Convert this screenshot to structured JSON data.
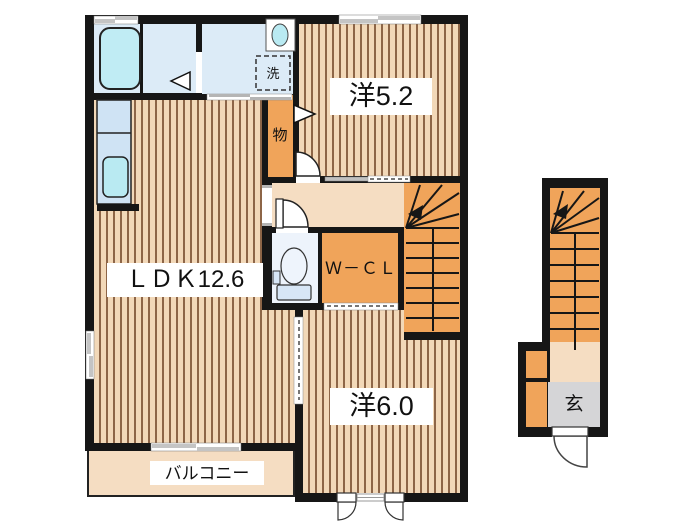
{
  "plan": {
    "type": "floor-plan",
    "floor2": {
      "labels": {
        "ldk": "ＬＤＫ12.6",
        "western52": "洋5.2",
        "western60": "洋6.0",
        "wcl": "Ｗ－ＣＬ",
        "storage": "物",
        "laundry": "洗",
        "balcony": "バルコニー"
      },
      "fixtures": [
        "bathtub",
        "washbasin",
        "washing-machine",
        "toilet",
        "kitchen-sink",
        "staircase"
      ]
    },
    "floor1": {
      "labels": {
        "entrance": "玄"
      },
      "fixtures": [
        "staircase",
        "entrance-door",
        "shoe-cabinet"
      ]
    },
    "colors": {
      "wall": "#161616",
      "wood_floor": "#f2d8b8",
      "wood_stripe": "#8d6547",
      "closet_orange": "#f0a45a",
      "hall_beige": "#f5ddc2",
      "wet_area_blue": "#dcebf7",
      "fixture_cyan": "#bdeaf3",
      "entrance_gray": "#d5d5d7"
    }
  }
}
